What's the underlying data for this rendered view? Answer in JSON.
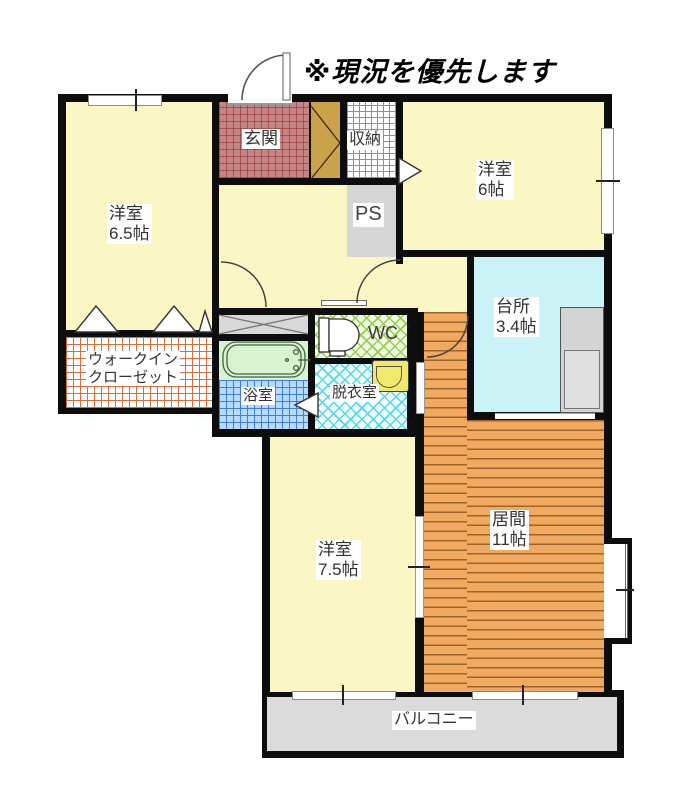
{
  "title": "※現況を優先します",
  "rooms": {
    "room65": {
      "name": "洋室",
      "size": "6.5帖"
    },
    "wic": {
      "line1": "ウォークイン",
      "line2": "クローゼット"
    },
    "genkan": {
      "name": "玄関"
    },
    "closet": {
      "name": "収納"
    },
    "ps": {
      "name": "PS"
    },
    "room6": {
      "name": "洋室",
      "size": "6帖"
    },
    "kitchen": {
      "name": "台所",
      "size": "3.4帖"
    },
    "wc": {
      "name": "WC"
    },
    "bath": {
      "name": "浴室"
    },
    "dressing": {
      "name": "脱衣室"
    },
    "room75": {
      "name": "洋室",
      "size": "7.5帖"
    },
    "living": {
      "name": "居間",
      "size": "11帖"
    },
    "balcony": {
      "name": "バルコニー"
    }
  },
  "colors": {
    "wall": "#0d0d0d",
    "room_yellow": "#FBF7C5",
    "kitchen_cyan": "#CBF3F6",
    "living_wood": "#F1A85F",
    "genkan_tile": "#C58585",
    "wic_grid_line": "#D96C3A",
    "closet_grid_line": "#E07840",
    "bath_tile": "#B7DBFF",
    "wc_green": "#8FD24A",
    "dressing_cyan": "#52D8E8",
    "tub_area_green": "#D9F2CF",
    "ps_gray": "#D6D6D6",
    "balcony_gray": "#DBDBDB",
    "shoebox_brown": "#C9A24B"
  }
}
